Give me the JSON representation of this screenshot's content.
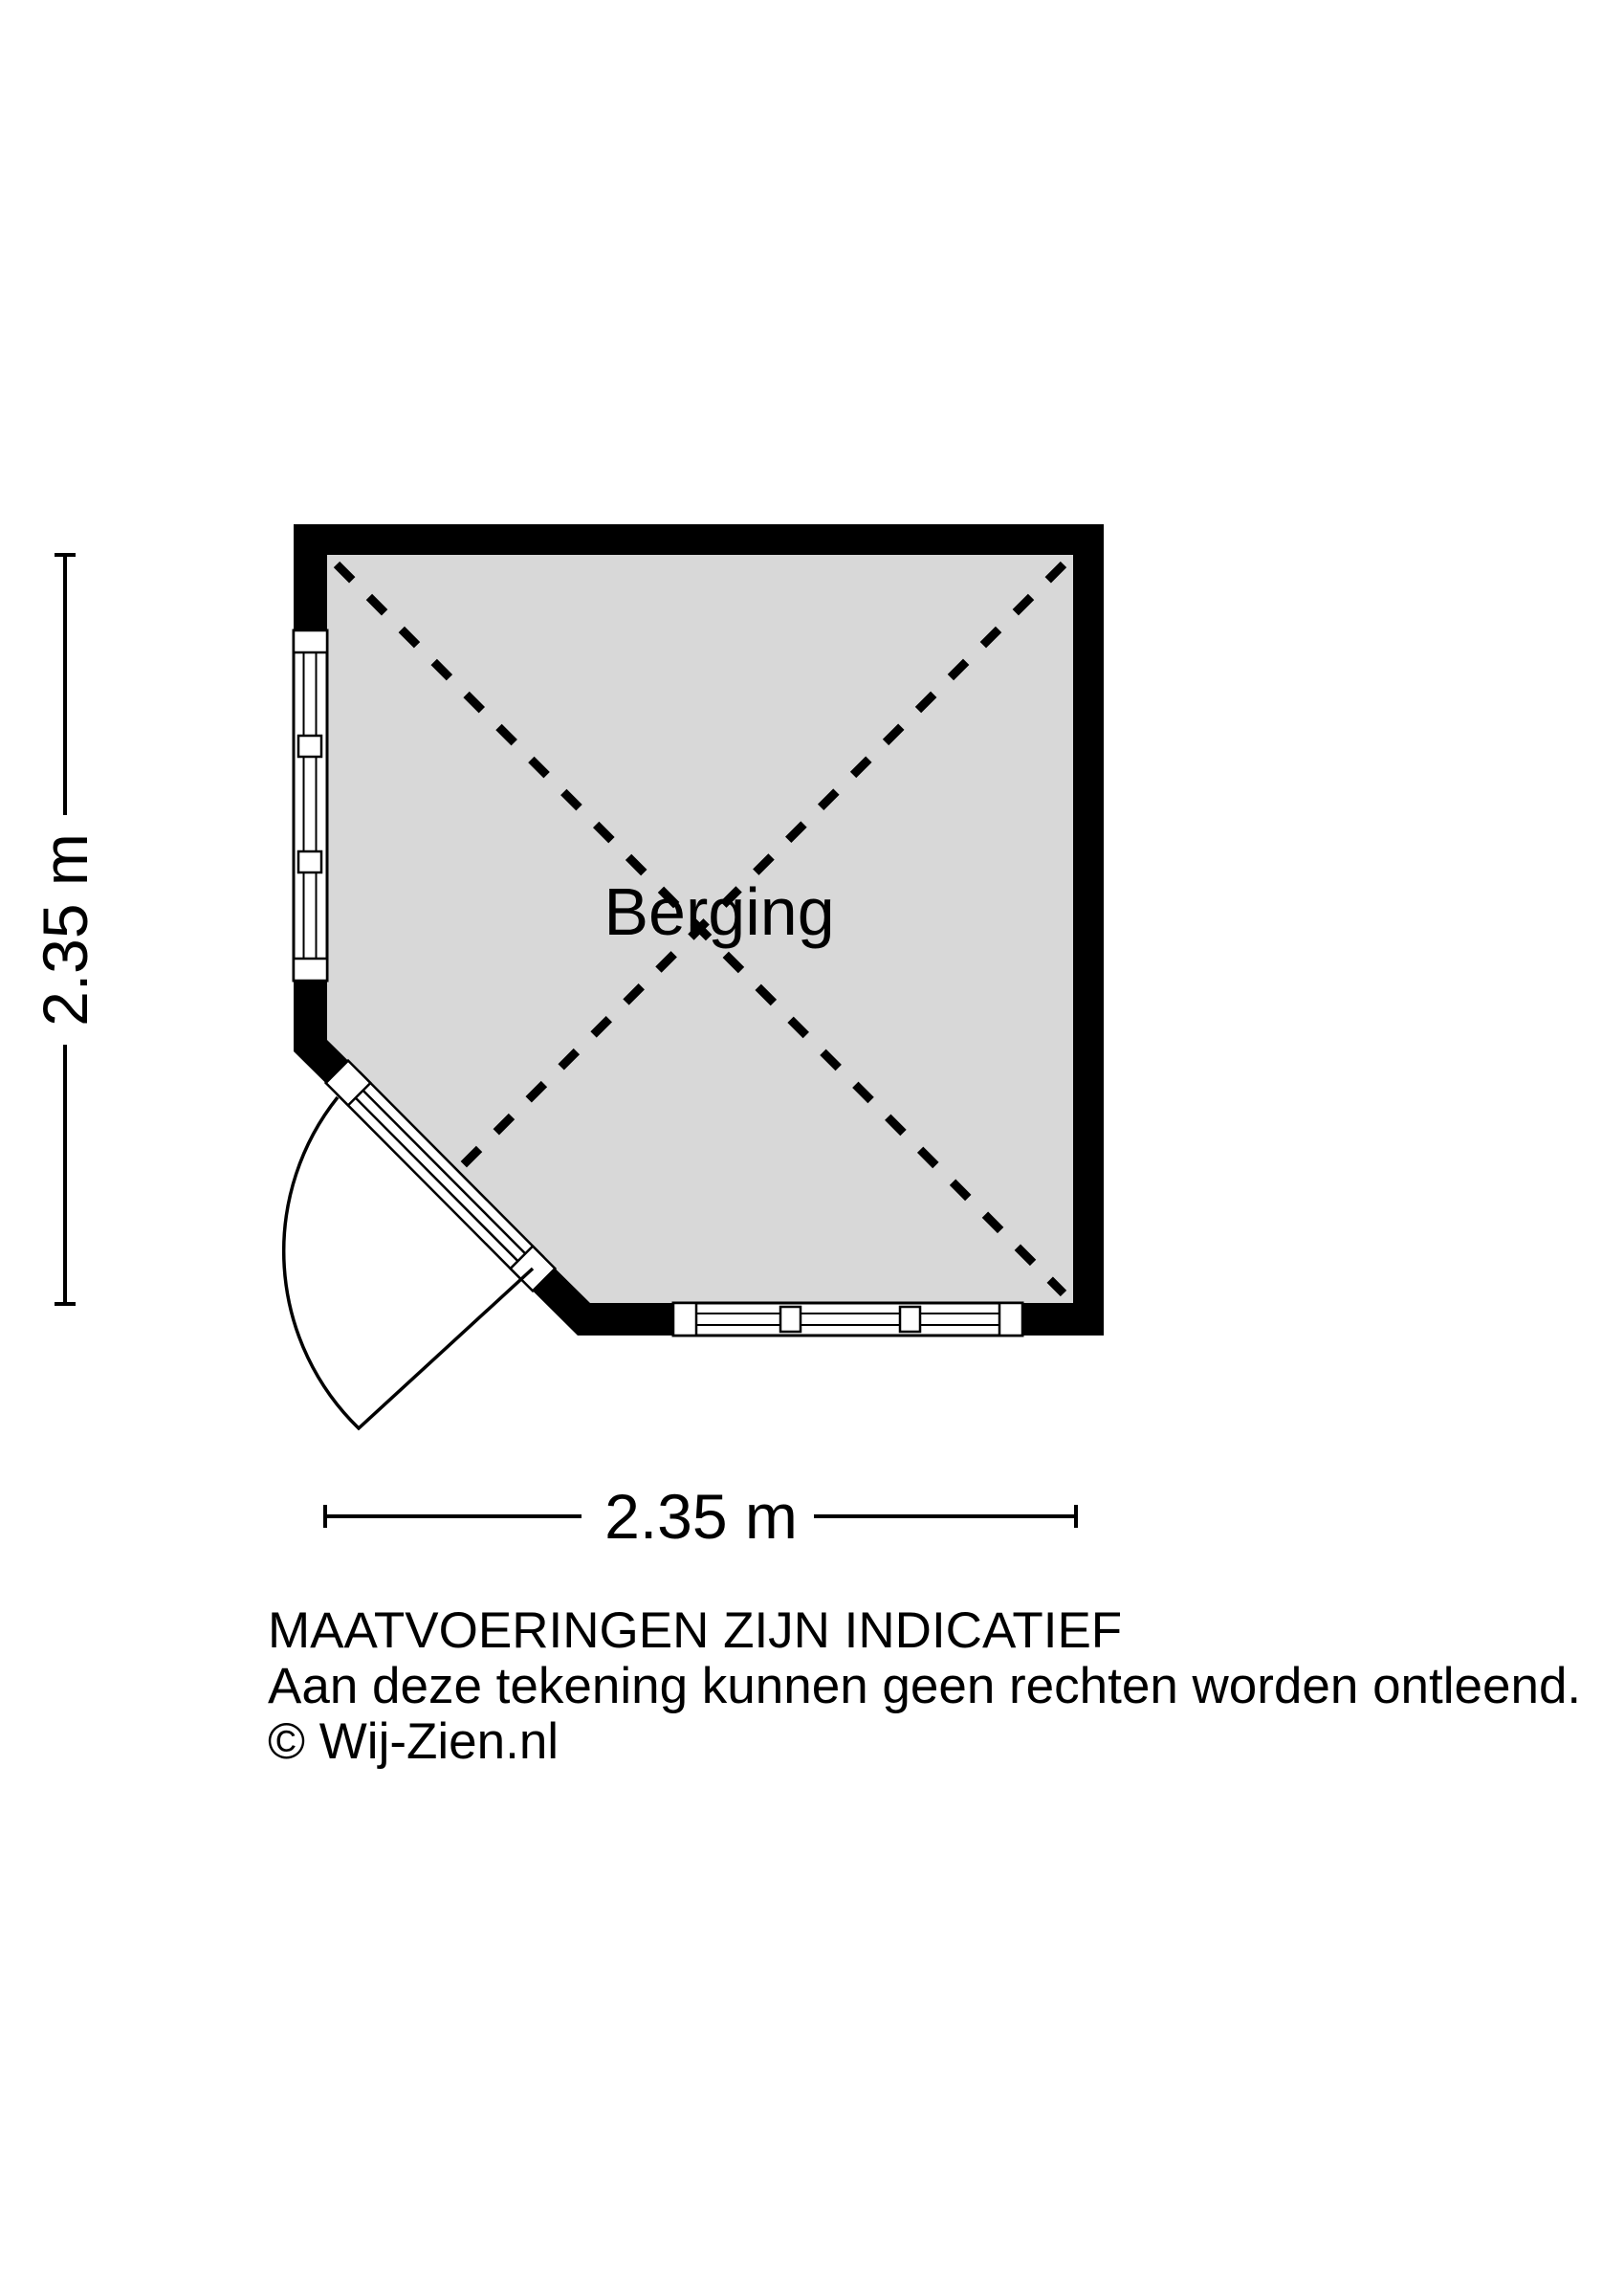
{
  "room": {
    "label": "Berging"
  },
  "dimensions": {
    "height": "2.35 m",
    "width": "2.35 m"
  },
  "footer": {
    "disclaimer_line1": "MAATVOERINGEN ZIJN INDICATIEF",
    "disclaimer_line2": "Aan deze tekening kunnen geen rechten worden ontleend.",
    "copyright": "© Wij-Zien.nl"
  },
  "colors": {
    "background": "#ffffff",
    "wall": "#000000",
    "floor_fill": "#d8d8d8",
    "line": "#000000",
    "window_fill": "#ffffff"
  }
}
